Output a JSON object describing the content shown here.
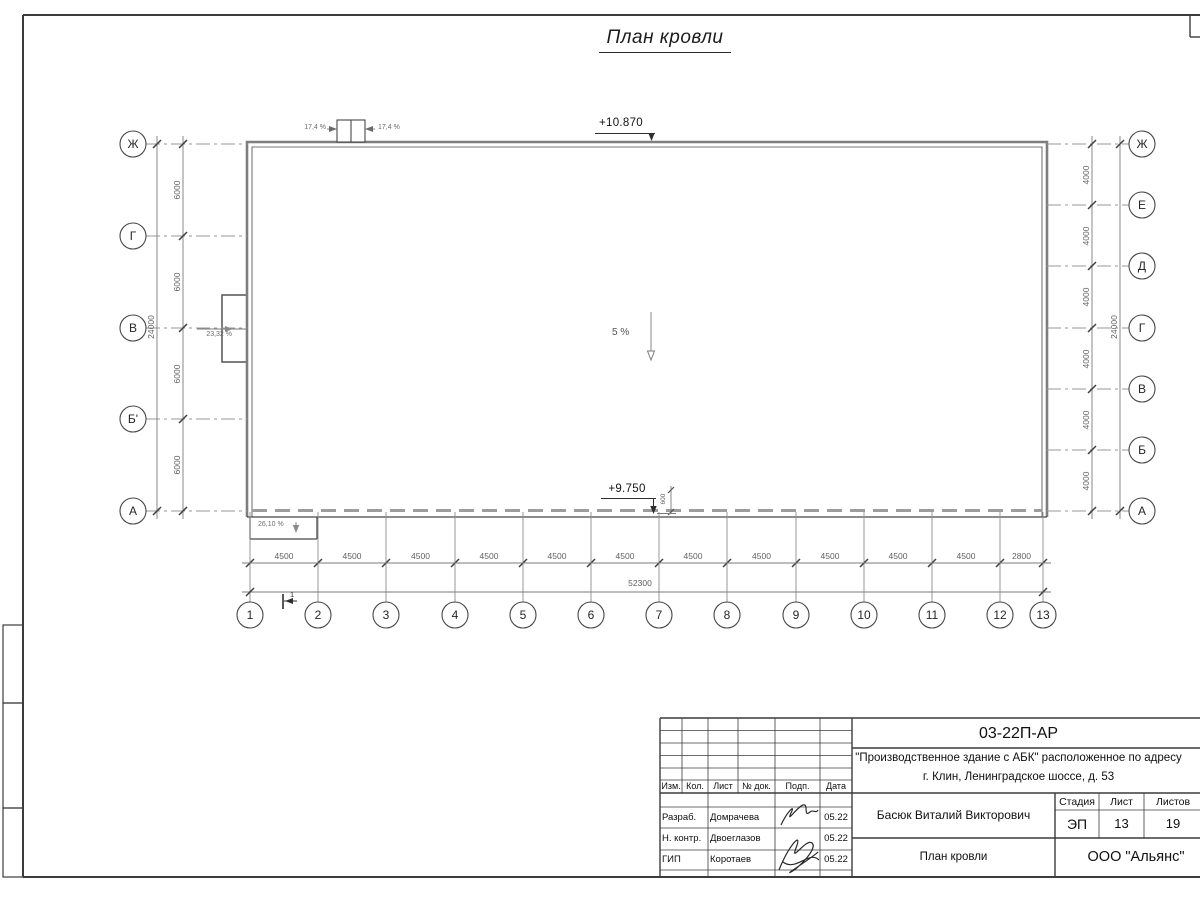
{
  "sheet": {
    "title": "План кровли",
    "colors": {
      "ink": "#3c3c3c",
      "line": "#474747",
      "thick_gray": "#7e7e7e",
      "dim": "#7b7b7b",
      "axis": "#979797",
      "dash": "#9d9d9d",
      "label": "#5f5f5f",
      "text": "#111111"
    }
  },
  "plan": {
    "elevation_top": "+10.870",
    "elevation_bottom": "+9.750",
    "parapet_dim": "600",
    "slope_center": "5 %",
    "slope_hatch_left": "17,4 %",
    "slope_hatch_right": "17,4 %",
    "slope_left": "23,32 %",
    "slope_bottom": "26,10 %",
    "section_mark": "1",
    "axes_left": [
      "Ж",
      "Г",
      "В",
      "Б'",
      "А"
    ],
    "axes_left_dims": [
      "6000",
      "6000",
      "6000",
      "6000"
    ],
    "axes_left_total": "24000",
    "axes_right": [
      "Ж",
      "Е",
      "Д",
      "Г",
      "В",
      "Б",
      "А"
    ],
    "axes_right_dims": [
      "4000",
      "4000",
      "4000",
      "4000",
      "4000",
      "4000"
    ],
    "axes_right_total": "24000",
    "axes_bottom": [
      "1",
      "2",
      "3",
      "4",
      "5",
      "6",
      "7",
      "8",
      "9",
      "10",
      "11",
      "12",
      "13"
    ],
    "axes_bottom_dims": [
      "4500",
      "4500",
      "4500",
      "4500",
      "4500",
      "4500",
      "4500",
      "4500",
      "4500",
      "4500",
      "4500",
      "2800"
    ],
    "axes_bottom_total": "52300"
  },
  "titleblock": {
    "doc_number": "03-22П-АР",
    "project_line1": "\"Производственное здание с АБК\" расположенное по адресу",
    "project_line2": "г. Клин, Ленинградское шоссе, д. 53",
    "rev_headers": [
      "Изм.",
      "Кол.",
      "Лист",
      "№ док.",
      "Подп.",
      "Дата"
    ],
    "sign_rows": [
      {
        "role": "Разраб.",
        "name": "Домрачева",
        "date": "05.22"
      },
      {
        "role": "Н. контр.",
        "name": "Двоеглазов",
        "date": "05.22"
      },
      {
        "role": "ГИП",
        "name": "Коротаев",
        "date": "05.22"
      }
    ],
    "chief_name": "Басюк Виталий Викторович",
    "stage_headers": [
      "Стадия",
      "Лист",
      "Листов"
    ],
    "stage": "ЭП",
    "sheet_no": "13",
    "sheets_total": "19",
    "drawing_title": "План кровли",
    "company": "ООО \"Альянс\""
  }
}
